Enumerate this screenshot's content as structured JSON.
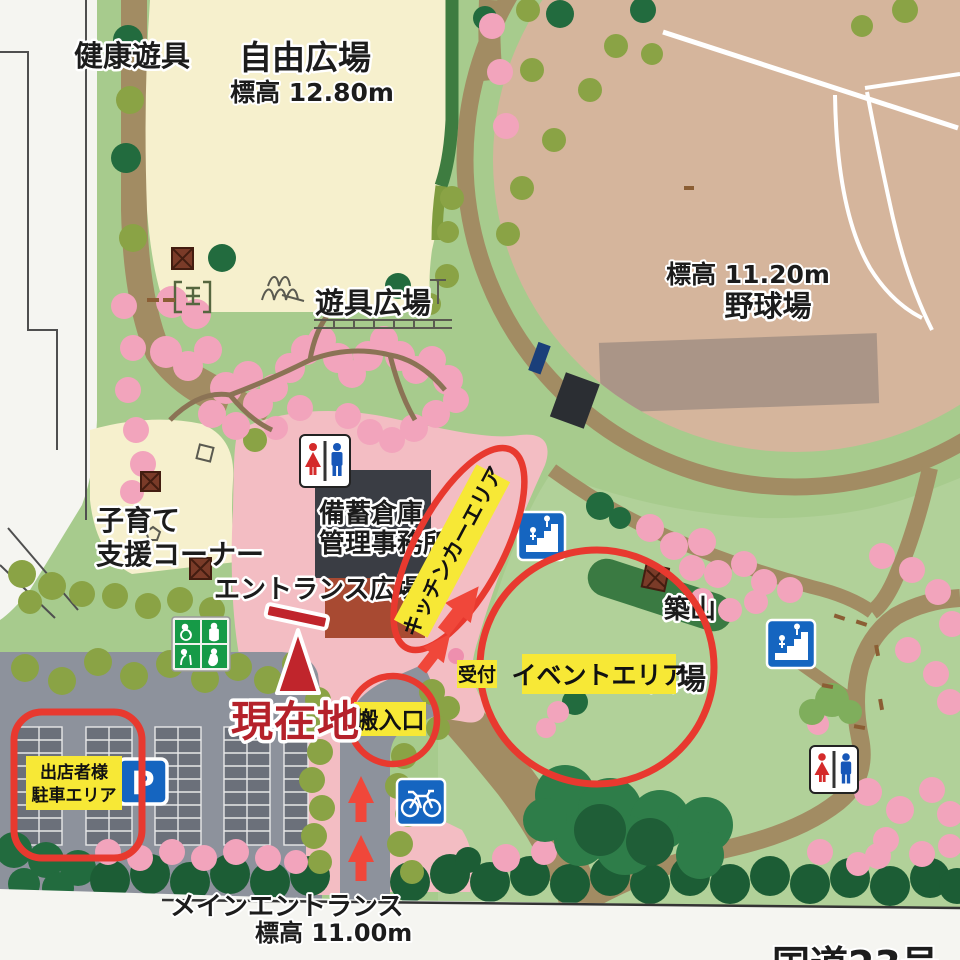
{
  "labels": {
    "health_equipment": "健康遊具",
    "free_plaza": "自由広場",
    "free_plaza_elev": "標高 12.80m",
    "playground": "遊具広場",
    "baseball_elev": "標高 11.20m",
    "baseball": "野球場",
    "childcare_1": "子育て",
    "childcare_2": "支援コーナー",
    "entrance_plaza": "エントランス広場",
    "warehouse_1": "備蓄倉庫",
    "warehouse_2": "管理事務所",
    "tsukiyama": "築山",
    "hidden_plaza": "広場",
    "main_entrance": "メインエントランス",
    "main_entrance_elev": "標高 11.00m",
    "route": "国道23号",
    "parking_p": "P"
  },
  "annotations": {
    "current_location": "現在地",
    "kitchen_car_area": "キッチンカーエリア",
    "reception": "受付",
    "loading_entrance": "搬入口",
    "event_area": "イベントエリア",
    "vendor_parking_1": "出店者様",
    "vendor_parking_2": "駐車エリア"
  },
  "colors": {
    "annotation_red": "#e8392f",
    "label_yellow": "#f7e836",
    "current_red": "#b5212a",
    "icon_blue": "#1565c0",
    "icon_green": "#169a47",
    "path_brown": "#a28c63",
    "field_tan": "#d5b59c",
    "plaza_pink": "#f3bdc3"
  }
}
